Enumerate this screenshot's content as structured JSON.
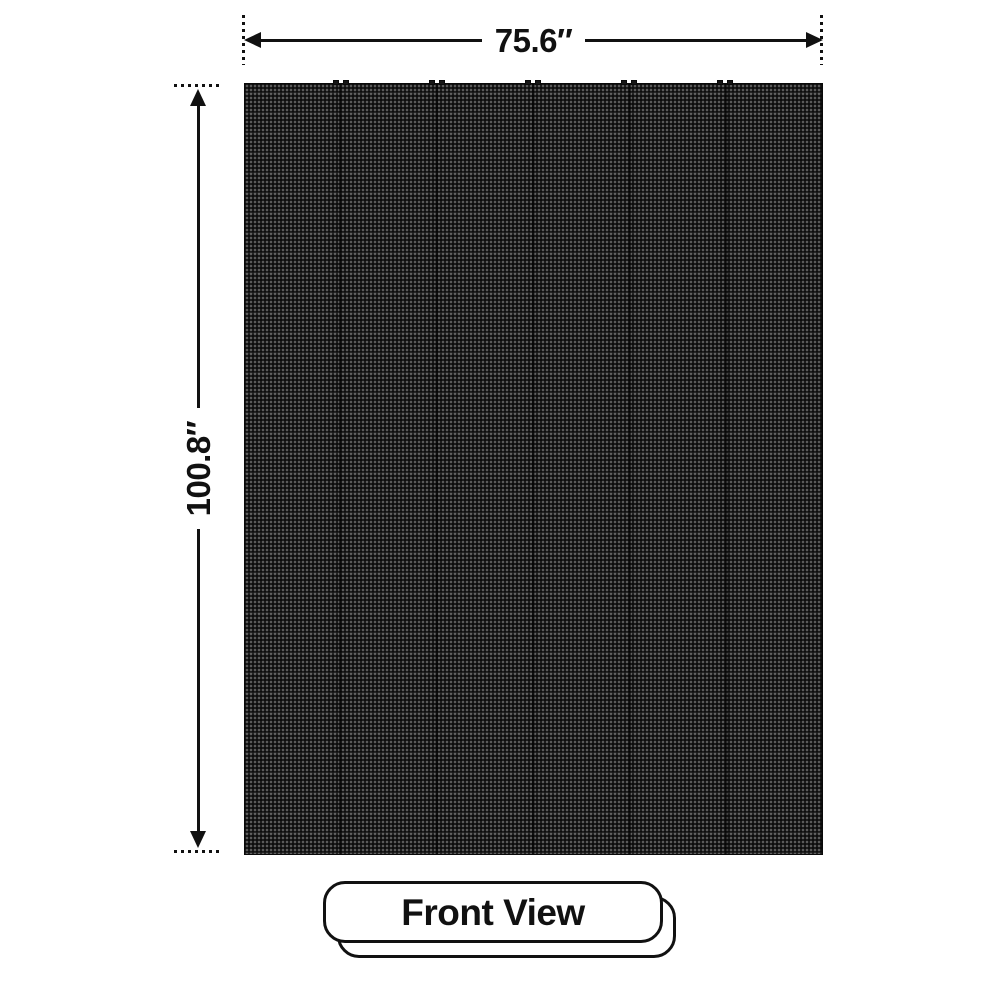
{
  "diagram": {
    "type": "product-dimension-diagram",
    "subject": "LED display panel, front view",
    "dimensions": {
      "width_label": "75.6″",
      "height_label": "100.8″"
    },
    "view": {
      "label": "Front View"
    },
    "icons": {
      "arrow_left": "left-arrowhead-triangle",
      "arrow_right": "right-arrowhead-triangle",
      "arrow_up": "up-arrowhead-triangle",
      "arrow_down": "down-arrowhead-triangle"
    },
    "colors": {
      "background": "#ffffff",
      "line": "#111111",
      "panel_base": "#0d0d0d",
      "panel_pixel_dot": "#5a5a5a",
      "card_background": "#ffffff"
    }
  }
}
